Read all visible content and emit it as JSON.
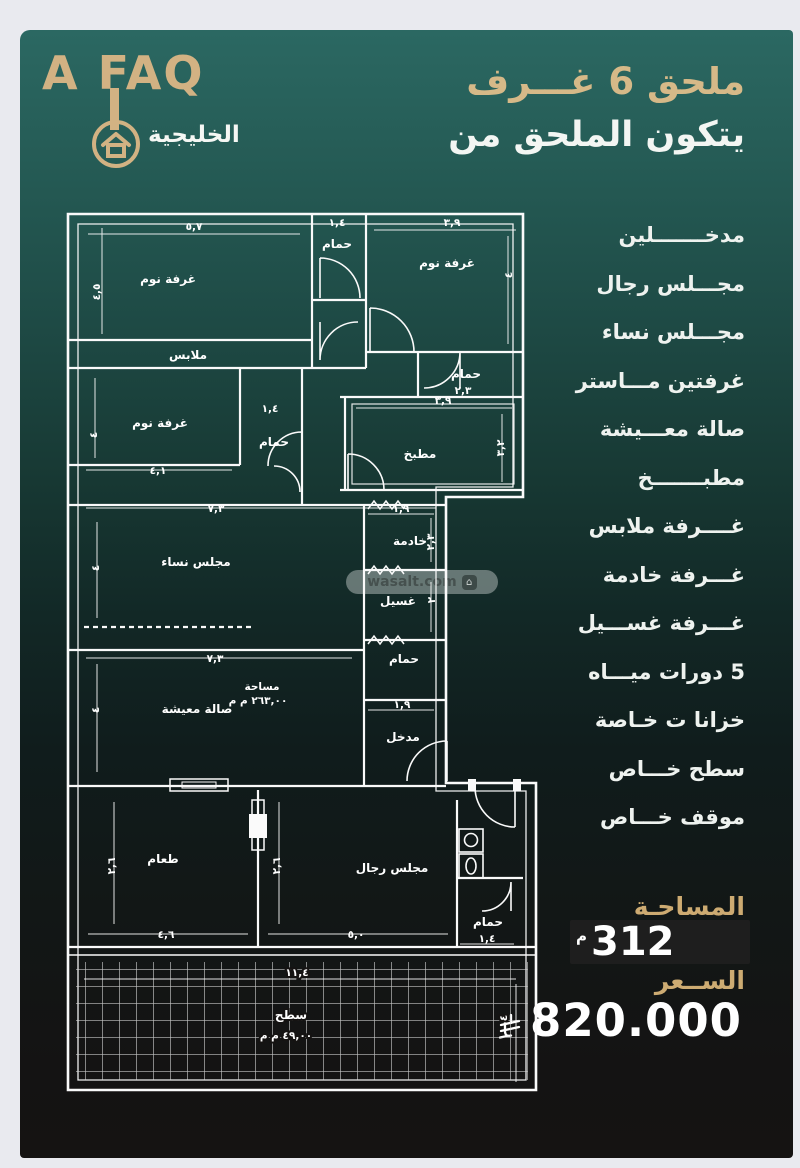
{
  "brand": {
    "name": "A FAQ",
    "sub": "الخليجية"
  },
  "headline": {
    "title": "ملحق 6 غـــرف",
    "subtitle": "يتكون الملحق من"
  },
  "features": [
    "مدخـــــــلين",
    "مجـــلس رجال",
    "مجـــلس نساء",
    "غرفتين مـــاستر",
    "صالة معـــيشة",
    "مطبـــــــخ",
    "غــــرفة ملابس",
    "غـــرفة خادمة",
    "غـــرفة غســـيل",
    "5 دورات ميـــاه",
    "خزانا ت خـاصة",
    "سطح خـــاص",
    "موقف خـــاص"
  ],
  "area": {
    "label": "المساحـة",
    "value": "312",
    "unit": "م"
  },
  "price": {
    "label": "الســعر",
    "value": "820.000",
    "currency_icon": "saudi-riyal-symbol"
  },
  "watermark": {
    "text": "wasalt.com"
  },
  "colors": {
    "gold": "#d2b283",
    "panel_top": "#2b6862",
    "panel_bottom": "#151312",
    "plan_line": "#fafafa",
    "box_bg": "#1e1e1e"
  },
  "floorplan": {
    "rooms": {
      "bed": "غرفة نوم",
      "bath": "حمام",
      "closet": "ملابس",
      "kitchen": "مطبخ",
      "maid": "خادمة",
      "laundry": "غسيل",
      "entry": "مدخل",
      "women_majlis": "مجلس نساء",
      "living": "صالة معيشة",
      "living_area_label": "مساحة",
      "living_area_value": "٢٦٣,٠٠ م م",
      "dining": "طعام",
      "men_majlis": "مجلس رجال",
      "roof": "سطح",
      "roof_area_value": "٤٩,٠٠ م م"
    },
    "dims": {
      "d57": "٥,٧",
      "d45": "٤,٥",
      "d14": "١,٤",
      "d39": "٣,٩",
      "d4": "٤",
      "d23": "٢,٣",
      "d41": "٤,١",
      "d73": "٧,٣",
      "d32": "٣,٢",
      "d19": "١,٩",
      "d2": "٢",
      "d26": "٢,٦",
      "d46": "٤,٦",
      "d50": "٥,٠",
      "d114": "١١,٤"
    }
  }
}
